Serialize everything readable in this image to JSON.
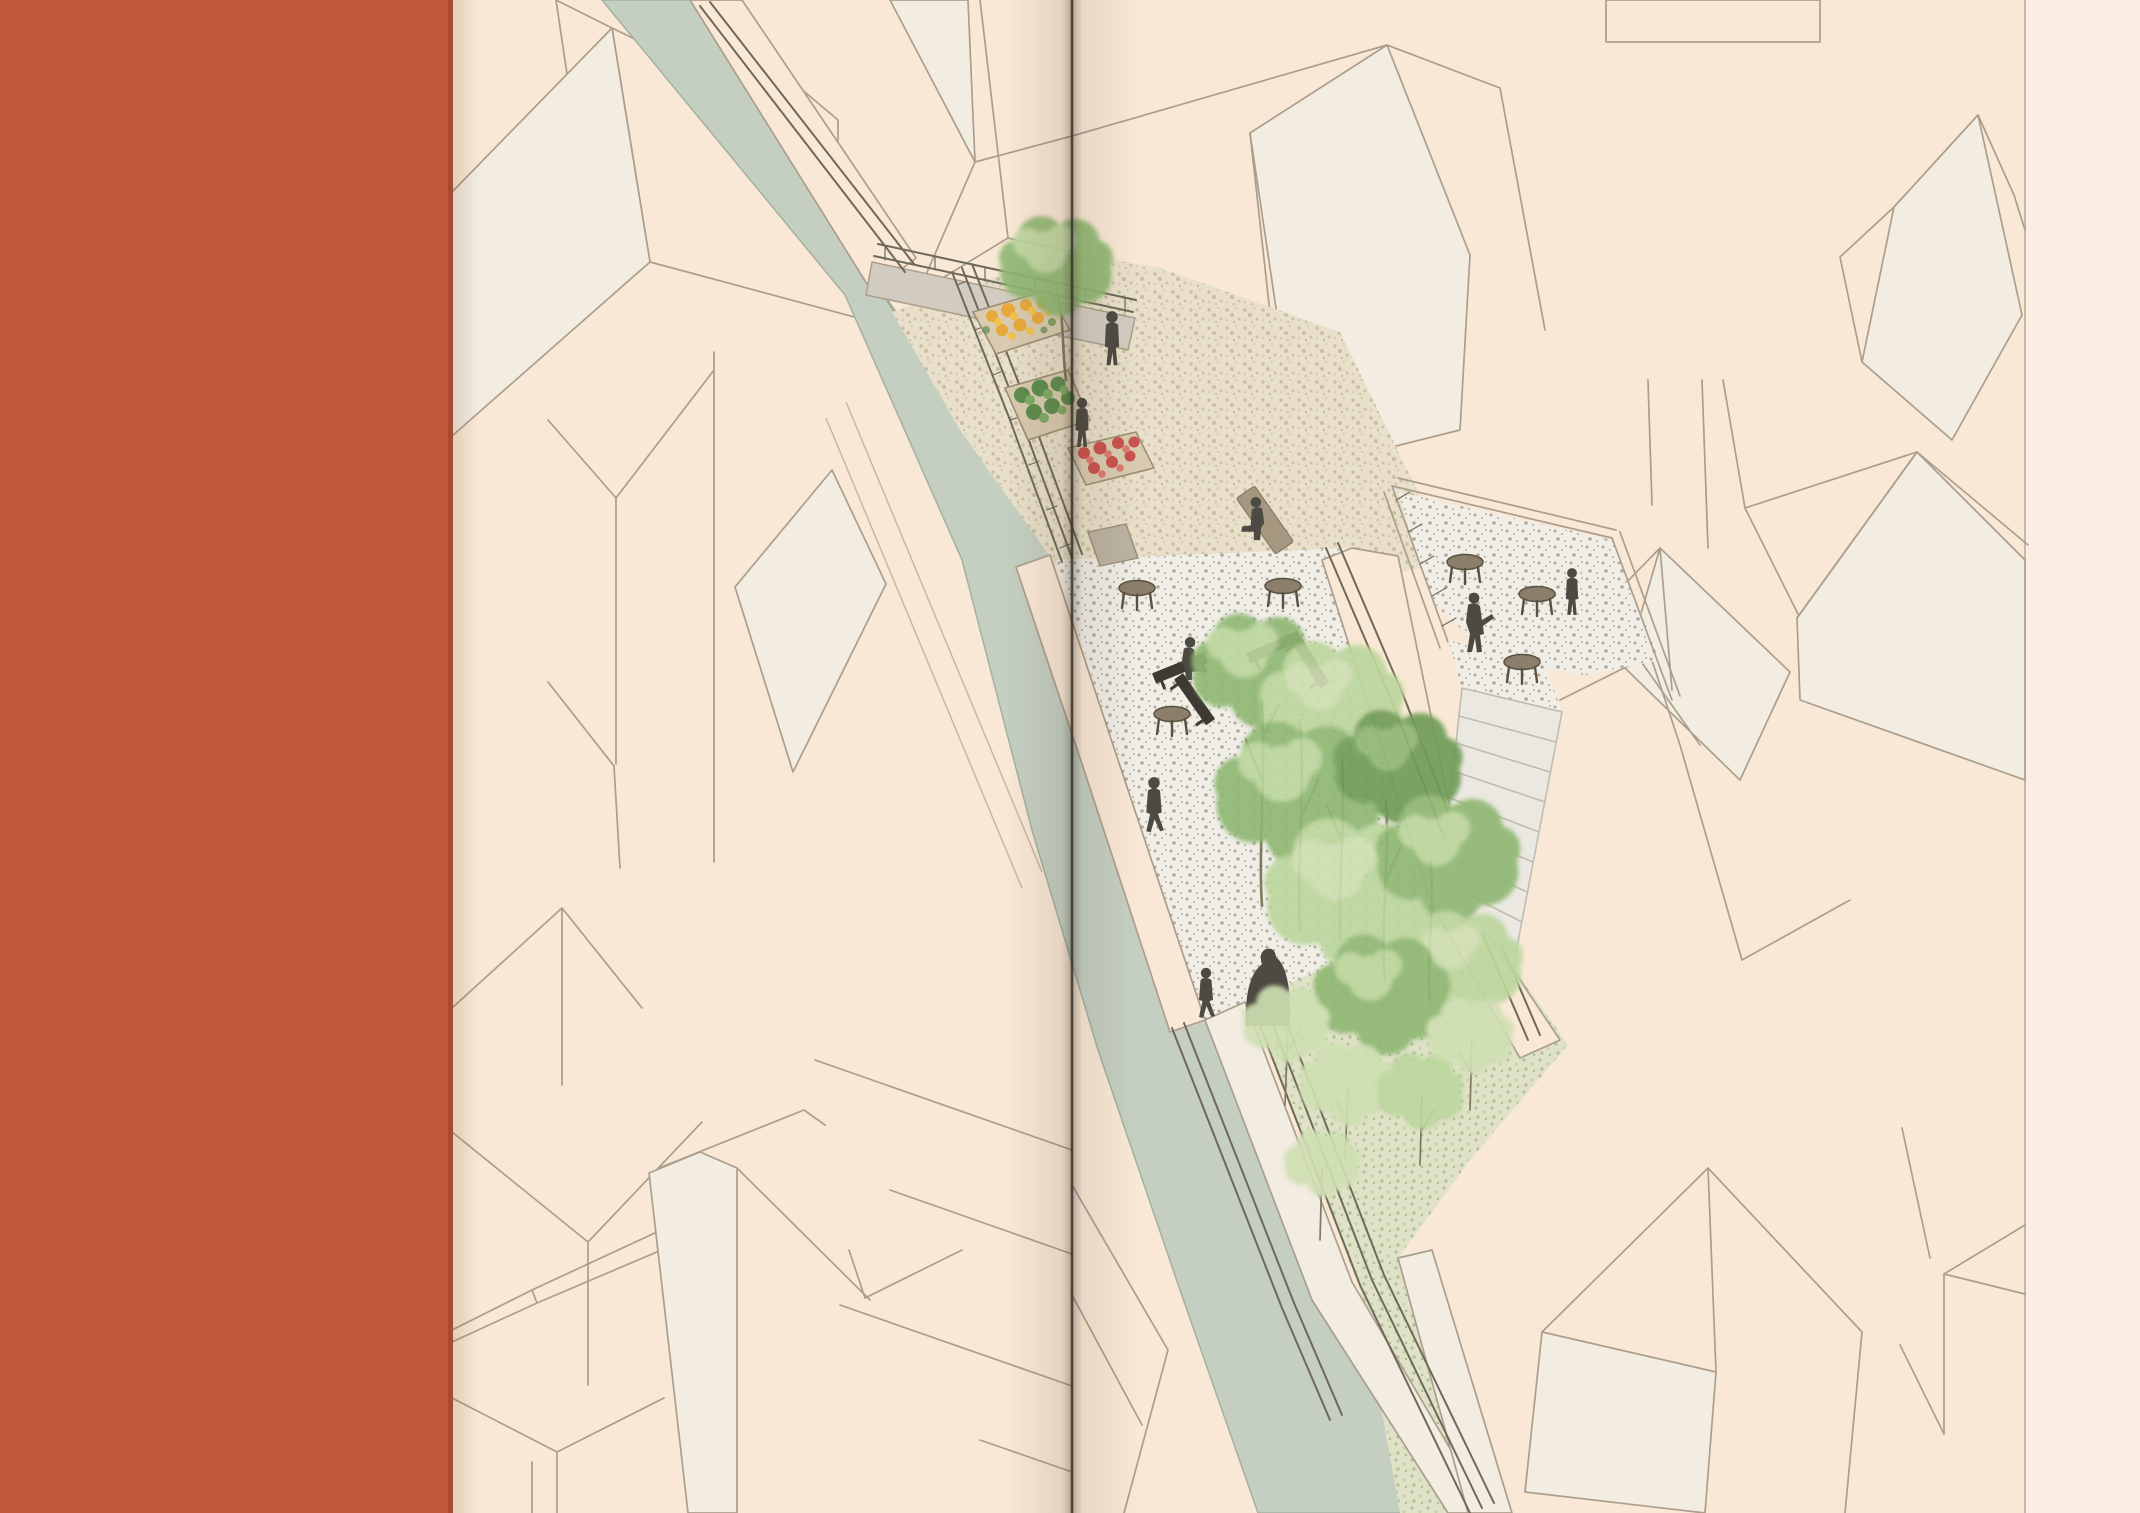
{
  "meta": {
    "kind": "scanned book spread, no visible text",
    "content": "architectural axonometric illustration of a narrow canal-side linear park between cream building volumes"
  },
  "palette": {
    "band": "#C2593C",
    "bandEdge": "#A64A31",
    "page": "#F9E8D5",
    "pageMargin": "#FAEDE1",
    "line": "#AC9E8C",
    "lineFaint": "#C6B8A4",
    "roofLight": "#F2ECE1",
    "canal": "#C4CFC2",
    "canalEdge": "#A3B1A0",
    "gravel": "#E8E0CA",
    "gravelDot": "#CCBF9F",
    "terrazzo": "#F0EEE7",
    "terrazzoDot": "#AEA99C",
    "lawn": "#DFE2C7",
    "lawnDot": "#B4C295",
    "treeDark": "#6F9C59",
    "treeMid": "#8FB873",
    "treeLight": "#BCD69D",
    "treePale": "#CFDFB2",
    "trunk": "#7E7A5F",
    "person": "#4C4A43",
    "table": "#8B7E6B",
    "tableEdge": "#59513F",
    "bench": "#3C3A32",
    "lounger": "#A59780",
    "stairs": "#EAE8E0",
    "stairEdge": "#BFBDB2",
    "rail": "#6E695B",
    "walkway": "#D2CCC0",
    "fold": "#3A332B",
    "flowerY": "#E8A93C",
    "flowerY2": "#F2C14E",
    "flowerR": "#C9524D",
    "flowerR2": "#DD7A70",
    "shrub": "#5E8D4E",
    "shrub2": "#7FAB66",
    "planter": "#D9CBAF",
    "planterEdge": "#9C8D74"
  },
  "layout_facts": {
    "image_width_px": 2140,
    "image_height_px": 1513,
    "orange_band_right_edge_px": 452,
    "spine_fold_x_px": 1072,
    "right_page_edge_x_px": 2025
  },
  "scene": {
    "canal": {
      "present": true,
      "runs": "from top edge diagonally to bottom edge, widening at bottom"
    },
    "garden_terrace": {
      "planters": [
        {
          "name": "planter-yellow-flowers"
        },
        {
          "name": "planter-green-shrubs"
        },
        {
          "name": "planter-red-flowers"
        }
      ],
      "tree_count": 1
    },
    "plaza": {
      "surface": "terrazzo",
      "cafe_table_count": 3,
      "bench_count": 2,
      "lounger_count": 1
    },
    "right_terrace": {
      "surface": "terrazzo",
      "cafe_table_count": 3,
      "stair_flight": true,
      "stair_step_count": 8
    },
    "lawn": {
      "slender_tree_count": 5
    },
    "tree_cluster_canopy_count": 8,
    "people_count": 9
  }
}
